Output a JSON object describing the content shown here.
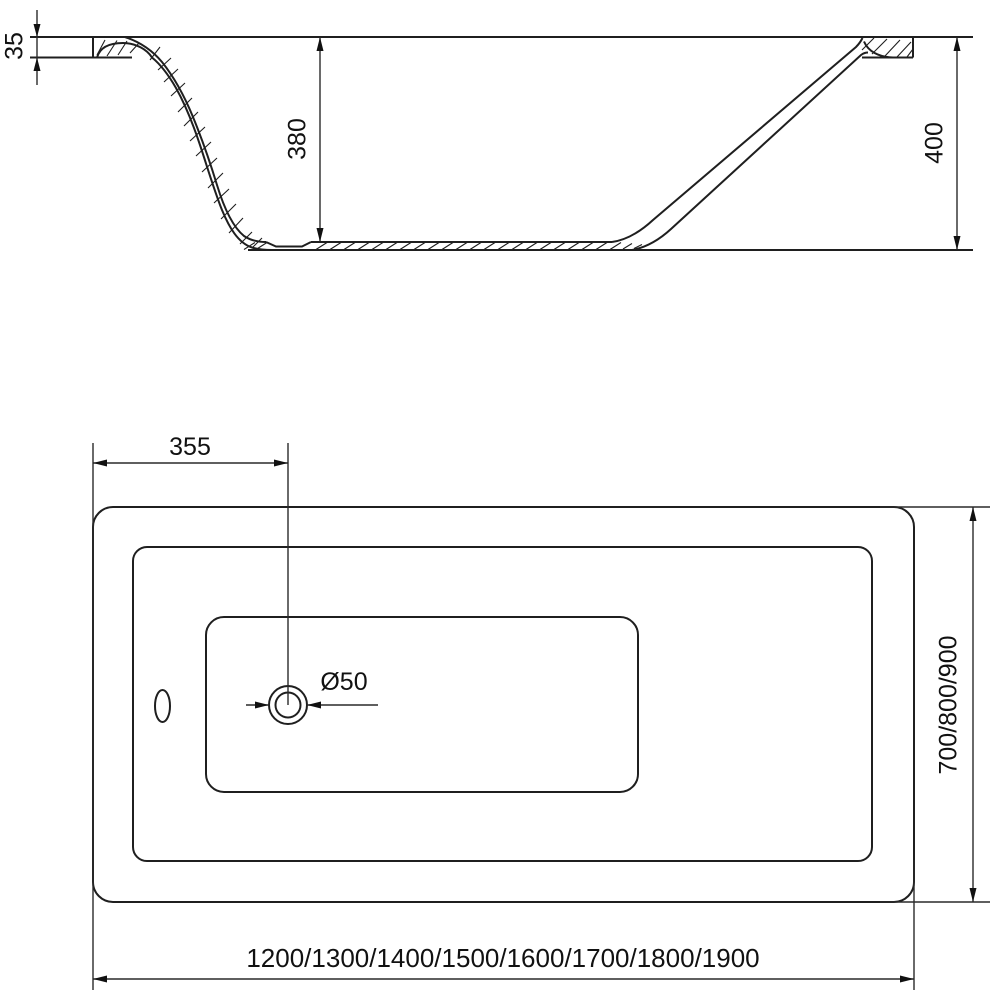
{
  "drawing": {
    "description": "Technical dimension drawing of a rectangular bathtub: side cross-section view (top) and plan view (bottom)",
    "colors": {
      "line": "#1f1f1f",
      "background": "#ffffff",
      "text": "#111111"
    },
    "side_view": {
      "rim_thickness_label": "35",
      "inner_depth_label": "380",
      "total_height_label": "400"
    },
    "plan_view": {
      "drain_offset_label": "355",
      "drain_diameter_label": "Ø50",
      "width_options_label": "700/800/900",
      "length_options_label": "1200/1300/1400/1500/1600/1700/1800/1900"
    }
  }
}
